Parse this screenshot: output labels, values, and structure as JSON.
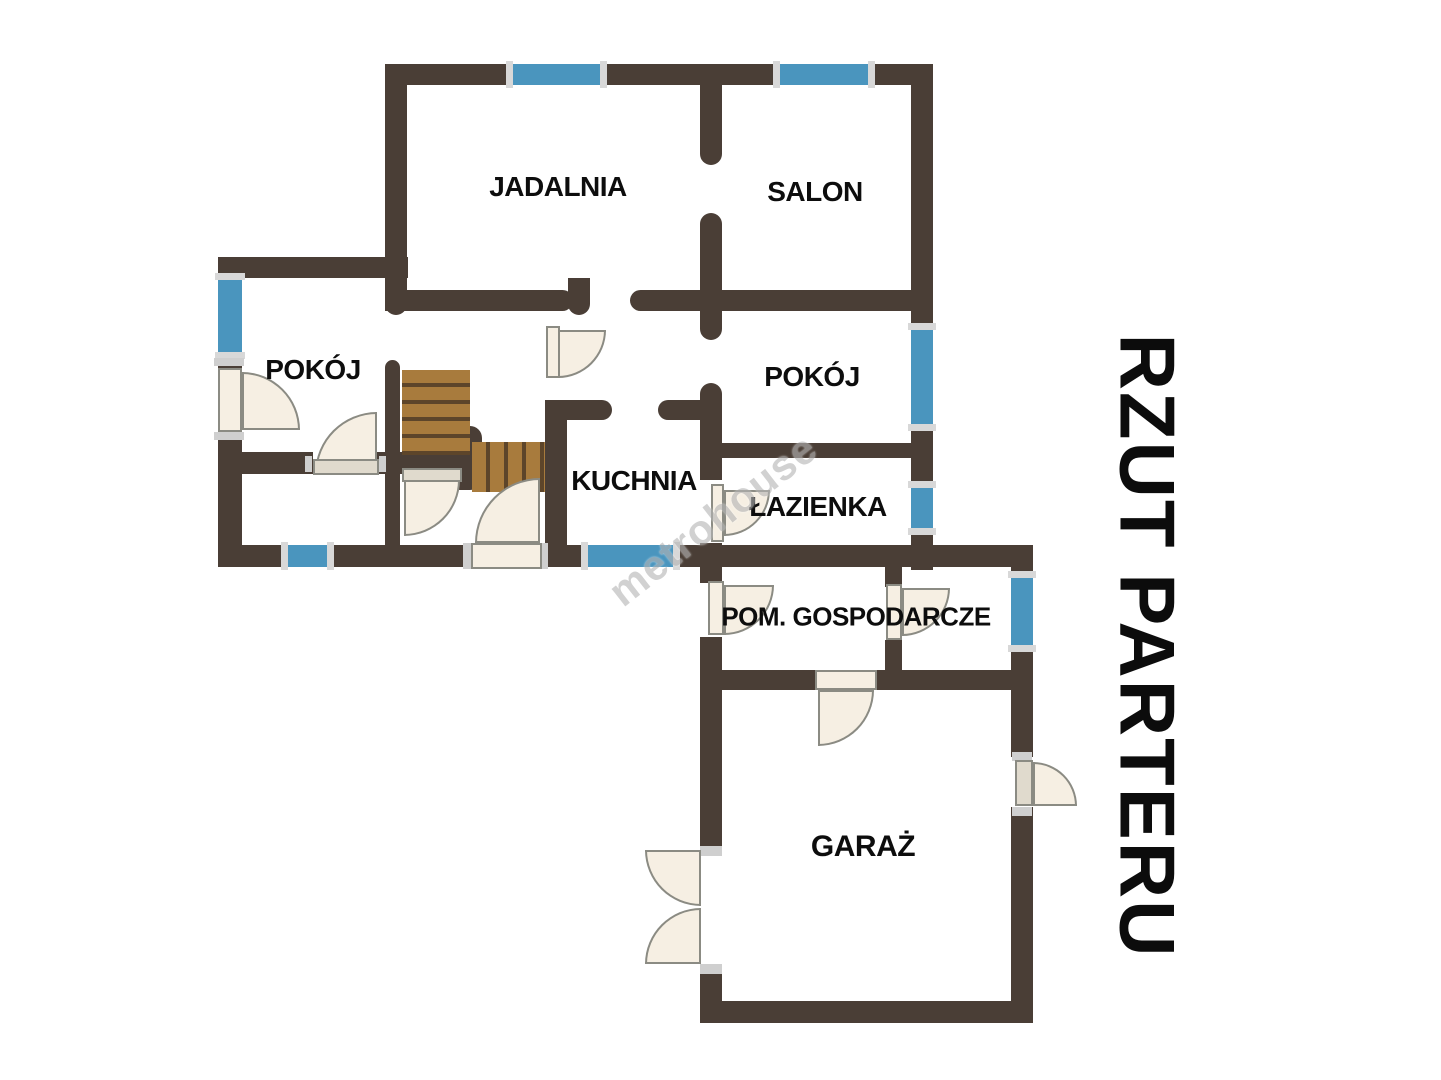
{
  "plan": {
    "side_title": "RZUT PARTERU",
    "watermark": "metrohouse",
    "rooms": [
      {
        "id": "jadalnia",
        "label": "JADALNIA"
      },
      {
        "id": "salon",
        "label": "SALON"
      },
      {
        "id": "pokoj-left",
        "label": "POKÓJ"
      },
      {
        "id": "pokoj-right",
        "label": "POKÓJ"
      },
      {
        "id": "kuchnia",
        "label": "KUCHNIA"
      },
      {
        "id": "lazienka",
        "label": "ŁAZIENKA"
      },
      {
        "id": "pom-gospodarcze",
        "label": "POM. GOSPODARCZE"
      },
      {
        "id": "garaz",
        "label": "GARAŻ"
      }
    ],
    "colors": {
      "wall": "#4a3e36",
      "window": "#4a95be",
      "window-cap": "#d8d8d8",
      "door": "#f6efe3",
      "door-muted": "#e0dacd",
      "stairs": "#a87b3d",
      "stairs-line": "#5d452a",
      "label": "#0d0d0d",
      "watermark": "#b5b5b5"
    }
  }
}
